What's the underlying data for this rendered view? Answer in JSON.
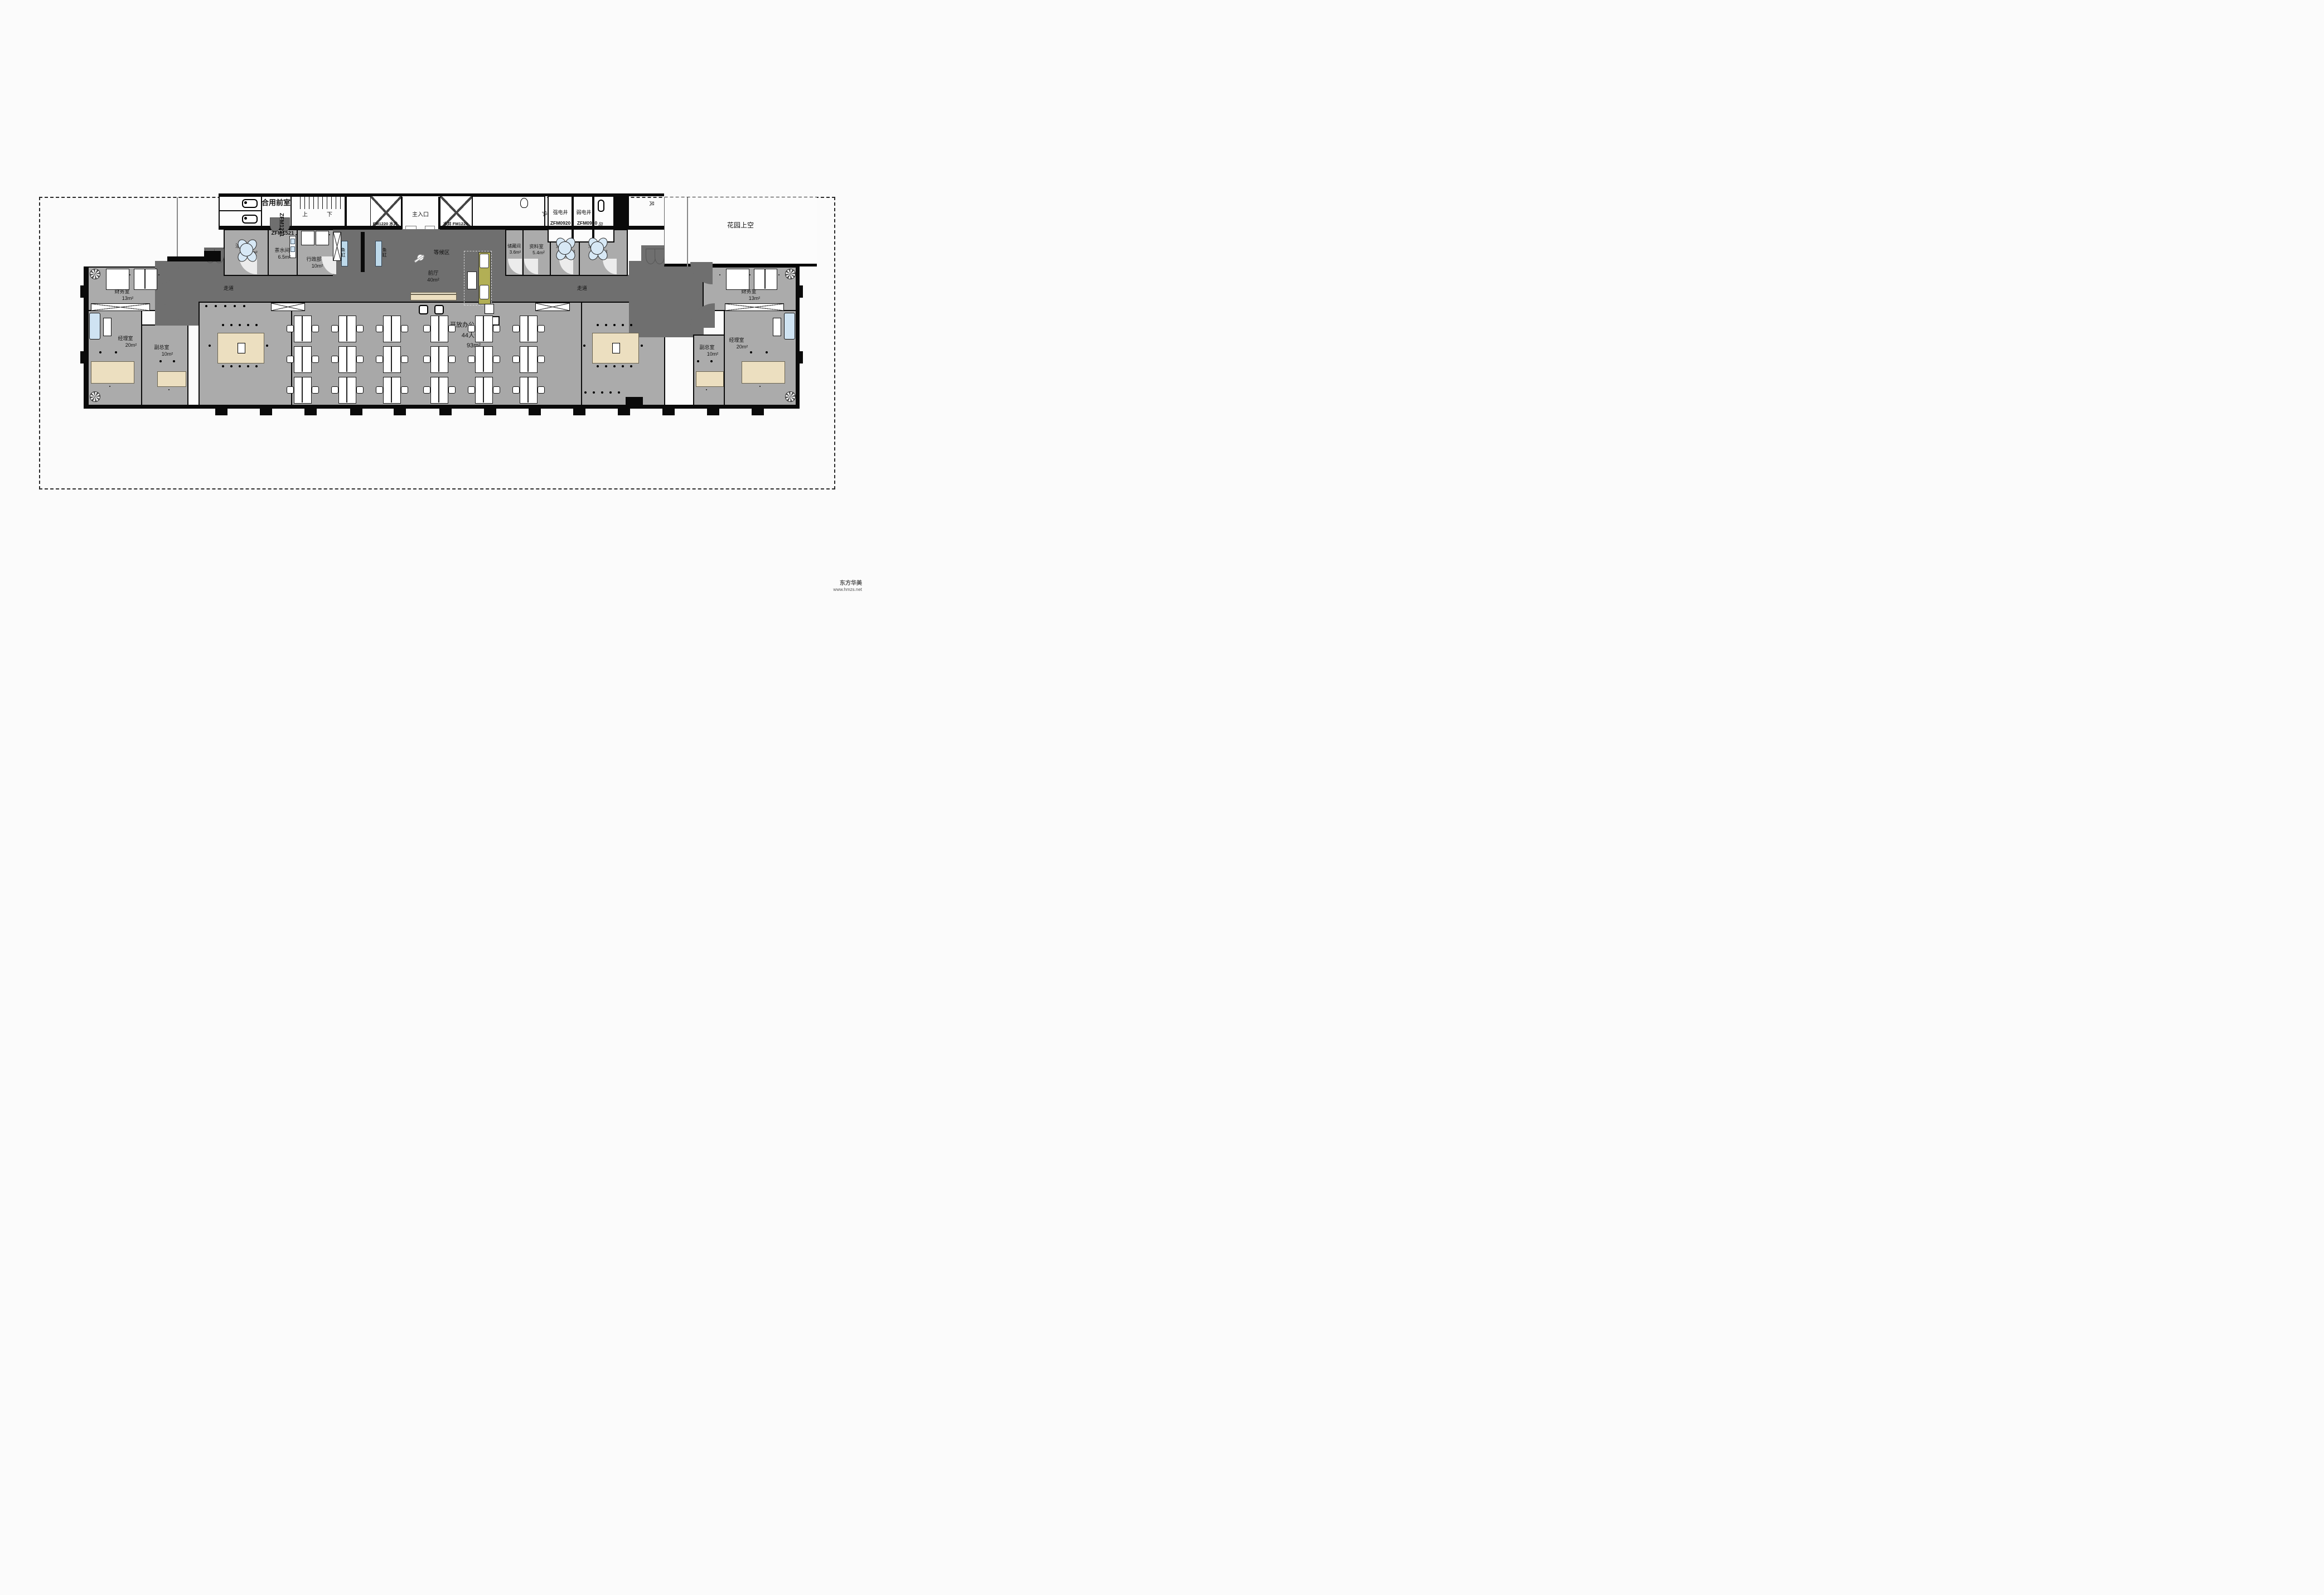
{
  "watermark": {
    "line1": "东方华美",
    "line2": "www.hmzs.net"
  },
  "labels": {
    "shared_front_room": "合用前室",
    "stair_up": "上",
    "stair_down": "下",
    "main_entrance": "主入口",
    "water_shaft_left": "FM1220 水井",
    "water_shaft_right": "水井 FM1220",
    "strong_shaft": "强电井",
    "weak_shaft": "弱电井",
    "air_shaft_1": "风",
    "air_shaft_2": "风",
    "air_shaft_3": "风",
    "garden": "花园上空",
    "corridor_left": "走道",
    "corridor_right": "走道",
    "waiting_area": "等候区",
    "fish_tank_a": "鱼缸",
    "fish_tank_b": "鱼缸"
  },
  "doors": {
    "zfm1221": "ZFM1221",
    "zfm1521": "ZFM1521",
    "zfm0920_a": "ZFM0920",
    "zfm0920_b": "ZFM0920"
  },
  "rooms": {
    "negotiation_1": {
      "name": "洽谈室1",
      "area": "7m²"
    },
    "tea": {
      "name": "茶水间",
      "area": "6.5m²"
    },
    "admin": {
      "name": "行政部",
      "area": "10m²"
    },
    "lobby": {
      "name": "前厅",
      "area": "40m²"
    },
    "storage": {
      "name": "储藏间",
      "area": "3.6m²"
    },
    "archive": {
      "name": "资料室",
      "area": "5.4m²"
    },
    "negotiation_2a": {
      "name": "洽谈室2",
      "area": "6m²"
    },
    "negotiation_2b": {
      "name": "洽谈室2",
      "area": "6m²"
    },
    "finance_left": {
      "name": "财务室",
      "area": "13m²"
    },
    "manager_left": {
      "name": "经理室",
      "area": "20m²"
    },
    "deputy_left": {
      "name": "副总室",
      "area": "10m²"
    },
    "conference_left": {
      "name": "会议室",
      "area": "33m²"
    },
    "open_office": {
      "name": "开放办公区",
      "seats": "44人位",
      "area": "93m²"
    },
    "conference_right": {
      "name": "会议室",
      "area": "33m²"
    },
    "deputy_right": {
      "name": "副总室",
      "area": "10m²"
    },
    "manager_right": {
      "name": "经理室",
      "area": "20m²"
    },
    "finance_right": {
      "name": "财务室",
      "area": "13m²"
    }
  },
  "colors": {
    "corridor": "#6f6f6f",
    "room_gray": "#ababab",
    "wall": "#0a0a0a",
    "table_tan": "#ecdfc0",
    "seat_blue": "#d7e8f5",
    "sofa_olive": "#b2af55",
    "tank_blue": "#bdd9ea"
  }
}
